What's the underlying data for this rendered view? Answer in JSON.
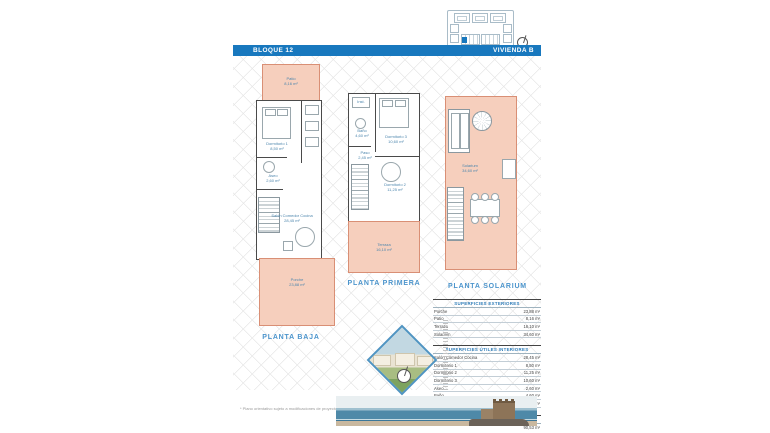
{
  "header": {
    "block_label": "BLOQUE 12",
    "unit_label": "VIVIENDA B"
  },
  "plans": {
    "baja": {
      "title": "PLANTA BAJA",
      "rooms": {
        "patio": {
          "name": "Patio",
          "area": "8,16 m²"
        },
        "dormitorio1": {
          "name": "Dormitorio 1",
          "area": "8,50 m²"
        },
        "aseo": {
          "name": "Aseo",
          "area": "2,60 m²"
        },
        "salon": {
          "name": "Salón Comedor Cocina",
          "area": "28,45 m²"
        },
        "porche": {
          "name": "Porche",
          "area": "23,88 m²"
        }
      }
    },
    "primera": {
      "title": "PLANTA PRIMERA",
      "rooms": {
        "inst": {
          "name": "Inst."
        },
        "bano": {
          "name": "Baño",
          "area": "4,60 m²"
        },
        "dormitorio3": {
          "name": "Dormitorio 3",
          "area": "10,60 m²"
        },
        "paso": {
          "name": "Paso",
          "area": "2,45 m²"
        },
        "dormitorio2": {
          "name": "Dormitorio 2",
          "area": "11,25 m²"
        },
        "terraza": {
          "name": "Terraza",
          "area": "16,10 m²"
        }
      }
    },
    "solarium": {
      "title": "PLANTA SOLARIUM",
      "rooms": {
        "solarium": {
          "name": "Solarium",
          "area": "34,60 m²"
        }
      }
    }
  },
  "surfaces": {
    "exteriores": {
      "header": "SUPERFICIES EXTERIORES",
      "rows": [
        {
          "label": "Porche",
          "value": "23,88 m²"
        },
        {
          "label": "Patio",
          "value": "8,16 m²"
        },
        {
          "label": "Terraza",
          "value": "16,10 m²"
        },
        {
          "label": "Solarium",
          "value": "34,60 m²"
        }
      ]
    },
    "interiores": {
      "header": "SUPERFICIES ÚTILES INTERIORES",
      "rows": [
        {
          "label": "Salón Comedor Cocina",
          "value": "28,45 m²"
        },
        {
          "label": "Dormitorio 1",
          "value": "8,50 m²"
        },
        {
          "label": "Dormitorio 2",
          "value": "11,25 m²"
        },
        {
          "label": "Dormitorio 3",
          "value": "10,60 m²"
        },
        {
          "label": "Aseo",
          "value": "2,60 m²"
        },
        {
          "label": "Baño",
          "value": "4,60 m²"
        },
        {
          "label": "Paso",
          "value": "2,45 m²"
        }
      ]
    },
    "construida": {
      "header": "SUPERFICIE CONSTRUIDA",
      "value": "90,53 m²"
    }
  },
  "footer": {
    "note": "* Plano orientativo sujeto a modificaciones de proyecto"
  },
  "colors": {
    "accent_blue": "#1878be",
    "title_blue": "#4b94cc",
    "room_fill": "#f6cfbd",
    "room_stroke": "#d98f75",
    "hatch_gray": "#e7e7e7"
  }
}
